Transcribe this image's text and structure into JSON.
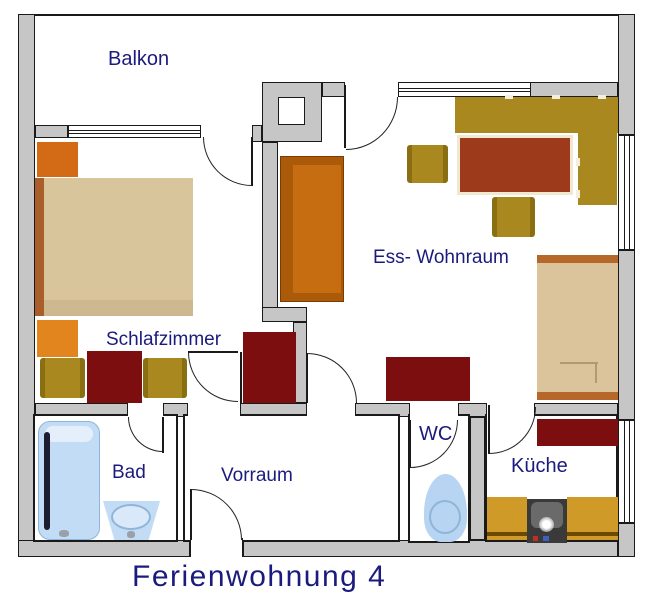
{
  "title": "Ferienwohnung 4",
  "rooms": {
    "balkon": {
      "label": "Balkon"
    },
    "schlafzimmer": {
      "label": "Schlafzimmer"
    },
    "ess_wohnraum": {
      "label": "Ess- Wohnraum"
    },
    "bad": {
      "label": "Bad"
    },
    "vorraum": {
      "label": "Vorraum"
    },
    "wc": {
      "label": "WC"
    },
    "kueche": {
      "label": "Küche"
    }
  },
  "colors": {
    "wall": "#c6c6c6",
    "outline": "#1a1a1a",
    "label_text": "#1b1b7e",
    "dark_red_furniture": "#7d0e10",
    "rust_table": "#9c3a1b",
    "orange_sofa": "#c66d12",
    "gold_seating": "#a8881f",
    "tan_bed": "#d9c59c",
    "sanitary_blue": "#bcd8f4",
    "kitchen_counter": "#d09a28"
  }
}
